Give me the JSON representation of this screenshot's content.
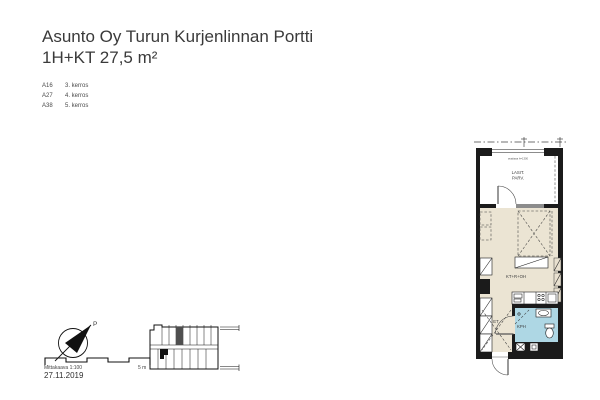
{
  "document": {
    "title": "Asunto Oy Turun Kurjenlinnan Portti",
    "subtitle": "1H+KT 27,5 m²",
    "date": "27.11.2019"
  },
  "apartment_list": {
    "units": [
      {
        "code": "A16",
        "floor": "3. kerros"
      },
      {
        "code": "A27",
        "floor": "4. kerros"
      },
      {
        "code": "A38",
        "floor": "5. kerros"
      }
    ]
  },
  "floor_plan": {
    "room_labels": {
      "balcony_line1": "LASIT.",
      "balcony_line2": "PARV.",
      "living_kitchen": "KT+R+OH",
      "entrance_hall": "ET",
      "bathroom": "KPH"
    },
    "balcony_note": "avattava h=1300",
    "colors": {
      "floor": "#ebe4d3",
      "wet_room": "#aed7e4",
      "wall": "#1b1b1b",
      "window": "#8c8c8c"
    }
  },
  "compass": {
    "north_label": "P"
  },
  "scale_bar": {
    "label": "Mittakaava 1:100",
    "end_label": "5 m"
  }
}
